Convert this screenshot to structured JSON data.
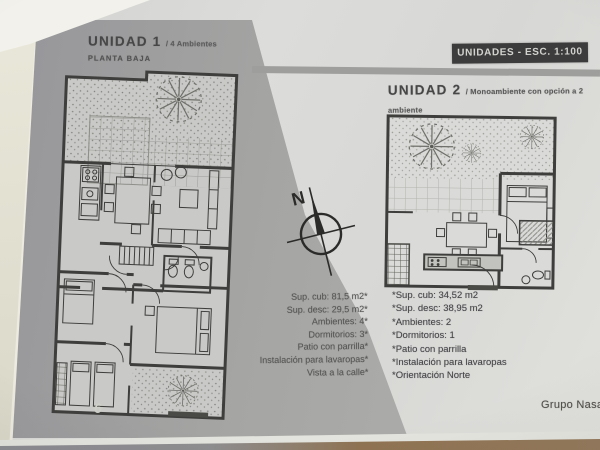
{
  "document": {
    "page_number": "6",
    "brand": "Grupo Nasa",
    "scale_badge": "UNIDADES - ESC. 1:100",
    "compass": {
      "north_label": "N"
    }
  },
  "unit1": {
    "title": "UNIDAD 1",
    "subtitle": "/ 4 Ambientes",
    "floor": "PLANTA BAJA",
    "specs": [
      "Sup. cub: 81,5 m2*",
      "Sup. desc: 29,5 m2*",
      "Ambientes: 4*",
      "Dormitorios: 3*",
      "Patio con parrilla*",
      "Instalación para lavaropas*",
      "Vista a la calle*"
    ]
  },
  "unit2": {
    "title": "UNIDAD 2",
    "subtitle": "/ Monoambiente con opción a 2 ambiente",
    "floor": "PLANTA BAJA",
    "specs": [
      "*Sup. cub: 34,52 m2",
      "*Sup. desc: 38,95 m2",
      "*Ambientes: 2",
      "*Dormitorios: 1",
      "*Patio con parrilla",
      "*Instalación para lavaropas",
      "*Orientación Norte"
    ]
  },
  "colors": {
    "band-gray": "#a5a5a3",
    "badge-bg": "#3c3c3c",
    "badge-text": "#d2d2ce",
    "table-brown": "#8f7352",
    "ink": "#3e3e3c"
  }
}
